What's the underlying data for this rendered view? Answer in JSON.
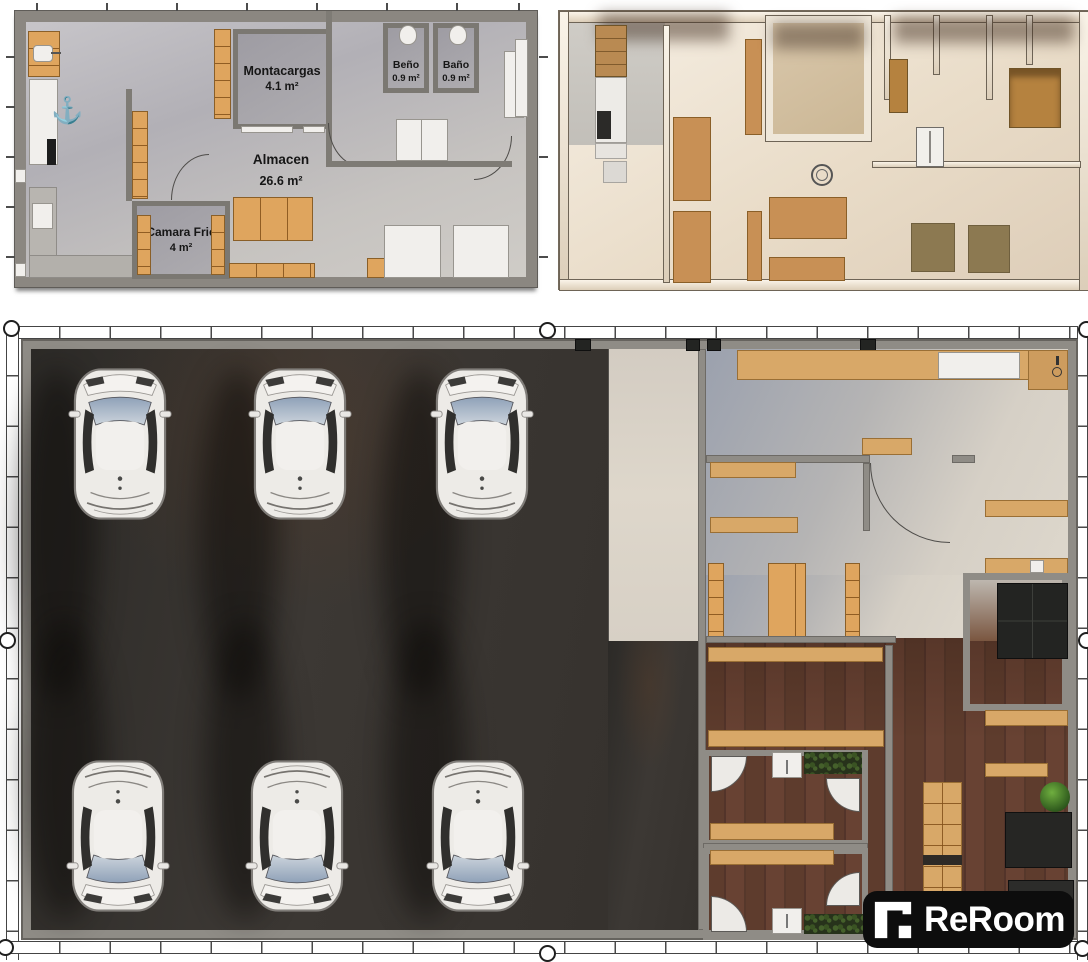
{
  "branding": {
    "logo_text": "ReRoom"
  },
  "plan_2d": {
    "rooms": [
      {
        "name": "Montacargas",
        "area": "4.1 m²"
      },
      {
        "name": "Beño",
        "area": "0.9 m²"
      },
      {
        "name": "Baño",
        "area": "0.9 m²"
      },
      {
        "name": "Almacen",
        "area": "26.6 m²"
      },
      {
        "name": "Camara Frie",
        "area": "4 m²"
      }
    ],
    "icons": {
      "anchor": "⚓"
    }
  },
  "colors": {
    "wall": "#8f8c86",
    "cabinet_orange": "#dfa55e",
    "counter_tan": "#d8a868",
    "asphalt": "#34312e",
    "wood": "#5b3b2c",
    "floor_2d": "#bfbdc2",
    "floor_3d": "#efe6d8",
    "logo_bg": "#0d0d0d",
    "logo_fg": "#ffffff"
  }
}
